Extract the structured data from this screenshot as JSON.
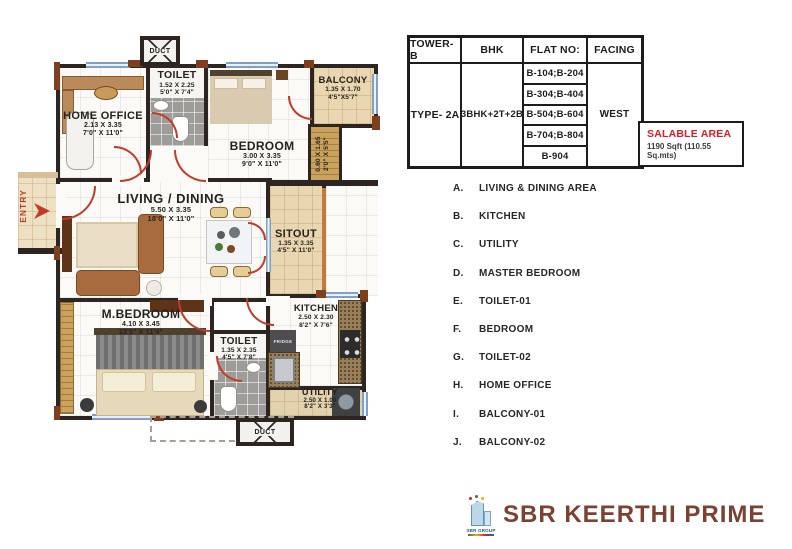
{
  "plan": {
    "entry_label": "ENTRY",
    "duct_label": "DUCT",
    "fridge_label": "FRIDGE",
    "rooms": [
      {
        "name": "HOME OFFICE",
        "dim_m": "2.13 X 3.35",
        "dim_ft": "7'0\" X 11'0\""
      },
      {
        "name": "TOILET",
        "dim_m": "1.52 X 2.25",
        "dim_ft": "5'0\" X 7'4\""
      },
      {
        "name": "BEDROOM",
        "dim_m": "3.00 X 3.35",
        "dim_ft": "9'0\" X 11'0\""
      },
      {
        "name": "BALCONY",
        "dim_m": "1.35 X 1.70",
        "dim_ft": "4'5\"X5'7\""
      },
      {
        "name": "",
        "dim_m": "0.60 X 1.65",
        "dim_ft": "2'0\" X 5'5\""
      },
      {
        "name": "LIVING / DINING",
        "dim_m": "5.50 X 3.35",
        "dim_ft": "18'0\" X 11'0\""
      },
      {
        "name": "SITOUT",
        "dim_m": "1.35 X 3.35",
        "dim_ft": "4'5\" X 11'0\""
      },
      {
        "name": "M.BEDROOM",
        "dim_m": "4.10 X 3.45",
        "dim_ft": "13'5\" X 11'4\""
      },
      {
        "name": "TOILET",
        "dim_m": "1.35 X 2.35",
        "dim_ft": "4'5\" X 7'8\""
      },
      {
        "name": "KITCHEN",
        "dim_m": "2.50 X 2.30",
        "dim_ft": "8'2\" X 7'6\""
      },
      {
        "name": "UTILITY",
        "dim_m": "2.50 X 1.00",
        "dim_ft": "8'2\" X 3'3\""
      }
    ]
  },
  "table": {
    "headers": [
      "TOWER-B",
      "BHK",
      "FLAT NO:",
      "FACING"
    ],
    "type": "TYPE- 2A",
    "bhk": "3BHK+2T+2B",
    "flats": [
      "B-104;B-204",
      "B-304;B-404",
      "B-504;B-604",
      "B-704;B-804",
      "B-904"
    ],
    "facing": "WEST"
  },
  "salable": {
    "title": "SALABLE AREA",
    "value": "1190 Sqft (110.55 Sq.mts)"
  },
  "legend": {
    "items": [
      {
        "key": "A.",
        "label": "LIVING & DINING AREA"
      },
      {
        "key": "B.",
        "label": "KITCHEN"
      },
      {
        "key": "C.",
        "label": "UTILITY"
      },
      {
        "key": "D.",
        "label": "MASTER BEDROOM"
      },
      {
        "key": "E.",
        "label": "TOILET-01"
      },
      {
        "key": "F.",
        "label": "BEDROOM"
      },
      {
        "key": "G.",
        "label": "TOILET-02"
      },
      {
        "key": "H.",
        "label": "HOME OFFICE"
      },
      {
        "key": "I.",
        "label": "BALCONY-01"
      },
      {
        "key": "J.",
        "label": "BALCONY-02"
      }
    ]
  },
  "footer": {
    "group_label": "SBR GROUP",
    "title": "SBR KEERTHI PRIME"
  },
  "colors": {
    "salable_red": "#e01b24",
    "title_maroon": "#7b4133",
    "door_arc_red": "#c23b2a",
    "wall_black": "#2d2521"
  }
}
